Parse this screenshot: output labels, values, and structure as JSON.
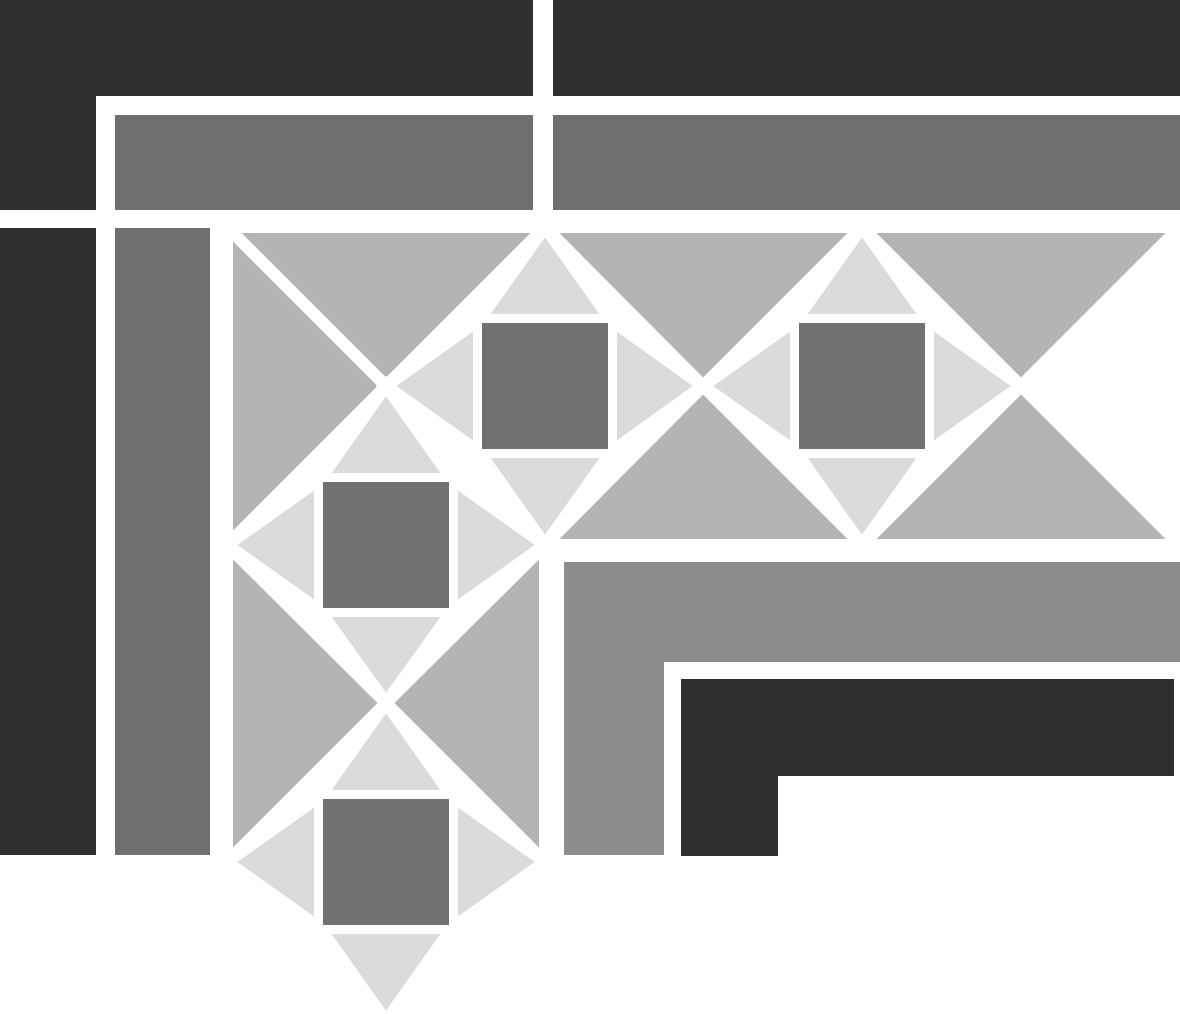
{
  "image": {
    "title": "grayscale-quilt-border-corner-pattern",
    "width": 1180,
    "height": 1014,
    "background": "#ffffff"
  },
  "palette": {
    "white": "#ffffff",
    "charcoal": "#2f2f31",
    "dark_gray": "#6f6f6f",
    "medium_gray": "#8d8d8d",
    "silver": "#b4b4b4",
    "light_gray": "#dbdbdb",
    "square_gray": "#717171"
  },
  "pattern_stroke": {
    "color": "#ffffff",
    "width": 12
  },
  "shapes": [
    {
      "name": "frame-top-left-dark-l",
      "fill": "charcoal",
      "outlined": false,
      "points": [
        [
          0,
          0
        ],
        [
          533,
          0
        ],
        [
          533,
          96
        ],
        [
          96,
          96
        ],
        [
          96,
          210
        ],
        [
          0,
          210
        ]
      ]
    },
    {
      "name": "frame-top-right-dark-bar",
      "fill": "charcoal",
      "outlined": false,
      "rect": [
        553,
        0,
        627,
        96
      ]
    },
    {
      "name": "frame-top-gray-bar-left",
      "fill": "dark_gray",
      "outlined": false,
      "rect": [
        115,
        115,
        418,
        95
      ]
    },
    {
      "name": "frame-top-gray-bar-right",
      "fill": "dark_gray",
      "outlined": false,
      "rect": [
        553,
        115,
        627,
        95
      ]
    },
    {
      "name": "frame-left-dark-column",
      "fill": "charcoal",
      "outlined": false,
      "rect": [
        0,
        228,
        96,
        627
      ]
    },
    {
      "name": "frame-left-gray-column",
      "fill": "dark_gray",
      "outlined": false,
      "rect": [
        115,
        228,
        95,
        627
      ]
    },
    {
      "name": "frame-right-medium-l-bar",
      "fill": "medium_gray",
      "outlined": false,
      "points": [
        [
          564,
          562
        ],
        [
          1180,
          562
        ],
        [
          1180,
          662
        ],
        [
          664,
          662
        ],
        [
          664,
          855
        ],
        [
          564,
          855
        ]
      ]
    },
    {
      "name": "frame-bottom-right-dark-step",
      "fill": "charcoal",
      "outlined": false,
      "points": [
        [
          681,
          679
        ],
        [
          1174,
          679
        ],
        [
          1174,
          776
        ],
        [
          778,
          776
        ],
        [
          778,
          856
        ],
        [
          681,
          856
        ]
      ]
    },
    {
      "name": "corner-block-top-triangle",
      "fill": "silver",
      "outlined": true,
      "points": [
        [
          227,
          227
        ],
        [
          545,
          227
        ],
        [
          386,
          386
        ]
      ]
    },
    {
      "name": "corner-block-left-triangle",
      "fill": "silver",
      "outlined": true,
      "points": [
        [
          227,
          227
        ],
        [
          386,
          386
        ],
        [
          227,
          545
        ]
      ]
    },
    {
      "name": "hband-hourglass-down-1",
      "fill": "silver",
      "outlined": true,
      "points": [
        [
          545,
          227
        ],
        [
          862,
          227
        ],
        [
          703,
          386
        ]
      ]
    },
    {
      "name": "hband-hourglass-up-1",
      "fill": "silver",
      "outlined": true,
      "points": [
        [
          545,
          545
        ],
        [
          703,
          386
        ],
        [
          862,
          545
        ]
      ]
    },
    {
      "name": "hband-hourglass-down-2",
      "fill": "silver",
      "outlined": true,
      "points": [
        [
          862,
          227
        ],
        [
          1180,
          227
        ],
        [
          1021,
          386
        ]
      ]
    },
    {
      "name": "hband-hourglass-up-2",
      "fill": "silver",
      "outlined": true,
      "points": [
        [
          862,
          545
        ],
        [
          1021,
          386
        ],
        [
          1180,
          545
        ]
      ]
    },
    {
      "name": "vband-hourglass-right",
      "fill": "silver",
      "outlined": true,
      "points": [
        [
          227,
          545
        ],
        [
          386,
          703
        ],
        [
          227,
          862
        ]
      ]
    },
    {
      "name": "vband-hourglass-left",
      "fill": "silver",
      "outlined": true,
      "points": [
        [
          545,
          545
        ],
        [
          545,
          862
        ],
        [
          386,
          703
        ]
      ]
    },
    {
      "name": "diamond-h1-top-triangle",
      "fill": "light_gray",
      "outlined": true,
      "points": [
        [
          479,
          320
        ],
        [
          611,
          320
        ],
        [
          545,
          227
        ]
      ]
    },
    {
      "name": "diamond-h1-right-triangle",
      "fill": "light_gray",
      "outlined": true,
      "points": [
        [
          611,
          320
        ],
        [
          703,
          386
        ],
        [
          611,
          452
        ]
      ]
    },
    {
      "name": "diamond-h1-bottom-triangle",
      "fill": "light_gray",
      "outlined": true,
      "points": [
        [
          479,
          452
        ],
        [
          545,
          545
        ],
        [
          611,
          452
        ]
      ]
    },
    {
      "name": "diamond-h1-left-triangle",
      "fill": "light_gray",
      "outlined": true,
      "points": [
        [
          479,
          320
        ],
        [
          479,
          452
        ],
        [
          386,
          386
        ]
      ]
    },
    {
      "name": "diamond-h2-top-triangle",
      "fill": "light_gray",
      "outlined": true,
      "points": [
        [
          796,
          320
        ],
        [
          928,
          320
        ],
        [
          862,
          227
        ]
      ]
    },
    {
      "name": "diamond-h2-right-triangle",
      "fill": "light_gray",
      "outlined": true,
      "points": [
        [
          928,
          320
        ],
        [
          1021,
          386
        ],
        [
          928,
          452
        ]
      ]
    },
    {
      "name": "diamond-h2-bottom-triangle",
      "fill": "light_gray",
      "outlined": true,
      "points": [
        [
          796,
          452
        ],
        [
          862,
          545
        ],
        [
          928,
          452
        ]
      ]
    },
    {
      "name": "diamond-h2-left-triangle",
      "fill": "light_gray",
      "outlined": true,
      "points": [
        [
          796,
          320
        ],
        [
          796,
          452
        ],
        [
          703,
          386
        ]
      ]
    },
    {
      "name": "diamond-v1-top-triangle",
      "fill": "light_gray",
      "outlined": true,
      "points": [
        [
          320,
          479
        ],
        [
          452,
          479
        ],
        [
          386,
          386
        ]
      ]
    },
    {
      "name": "diamond-v1-right-triangle",
      "fill": "light_gray",
      "outlined": true,
      "points": [
        [
          452,
          479
        ],
        [
          545,
          545
        ],
        [
          452,
          611
        ]
      ]
    },
    {
      "name": "diamond-v1-bottom-triangle",
      "fill": "light_gray",
      "outlined": true,
      "points": [
        [
          320,
          611
        ],
        [
          386,
          703
        ],
        [
          452,
          611
        ]
      ]
    },
    {
      "name": "diamond-v1-left-triangle",
      "fill": "light_gray",
      "outlined": true,
      "points": [
        [
          320,
          479
        ],
        [
          320,
          611
        ],
        [
          227,
          545
        ]
      ]
    },
    {
      "name": "diamond-v2-top-triangle",
      "fill": "light_gray",
      "outlined": true,
      "points": [
        [
          320,
          796
        ],
        [
          452,
          796
        ],
        [
          386,
          703
        ]
      ]
    },
    {
      "name": "diamond-v2-right-triangle",
      "fill": "light_gray",
      "outlined": true,
      "points": [
        [
          452,
          796
        ],
        [
          545,
          862
        ],
        [
          452,
          928
        ]
      ]
    },
    {
      "name": "diamond-v2-bottom-triangle",
      "fill": "light_gray",
      "outlined": true,
      "points": [
        [
          320,
          928
        ],
        [
          386,
          1021
        ],
        [
          452,
          928
        ]
      ]
    },
    {
      "name": "diamond-v2-left-triangle",
      "fill": "light_gray",
      "outlined": true,
      "points": [
        [
          320,
          796
        ],
        [
          320,
          928
        ],
        [
          227,
          862
        ]
      ]
    },
    {
      "name": "diamond-h1-square",
      "fill": "square_gray",
      "outlined": false,
      "rect": [
        482,
        323,
        126,
        126
      ]
    },
    {
      "name": "diamond-h2-square",
      "fill": "square_gray",
      "outlined": false,
      "rect": [
        799,
        323,
        126,
        126
      ]
    },
    {
      "name": "diamond-v1-square",
      "fill": "square_gray",
      "outlined": false,
      "rect": [
        323,
        482,
        126,
        126
      ]
    },
    {
      "name": "diamond-v2-square",
      "fill": "square_gray",
      "outlined": false,
      "rect": [
        323,
        799,
        126,
        126
      ]
    }
  ]
}
